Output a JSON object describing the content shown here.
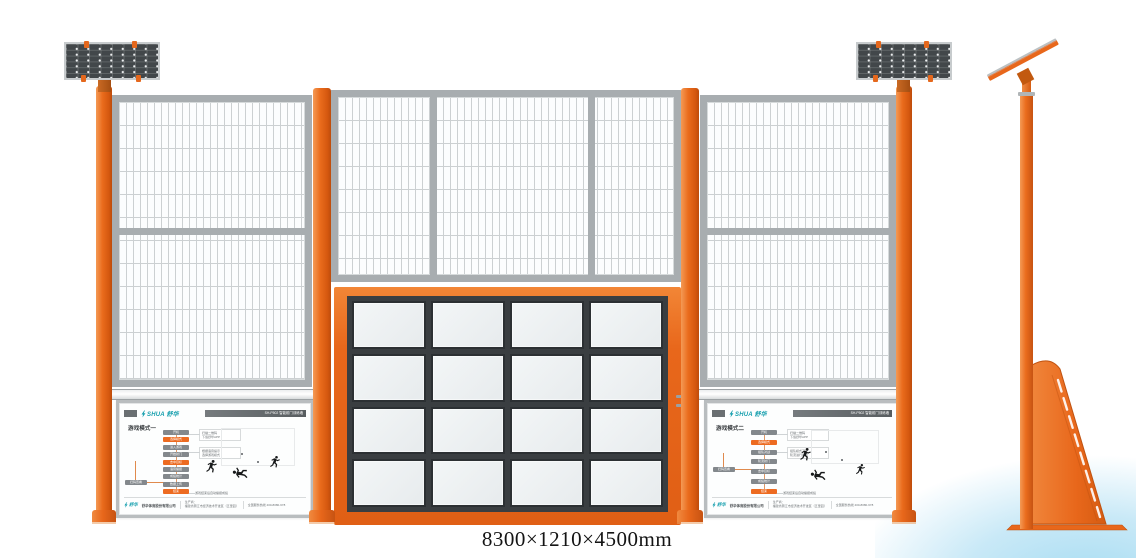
{
  "page": {
    "dimension_label": "8300×1210×4500mm"
  },
  "colors": {
    "orange": "#e8671b",
    "orange_dark": "#c75312",
    "frame_gray": "#a8adb0",
    "mesh_line": "#ccd0d2",
    "solar_cell_dark": "#42474a",
    "screen_frame_dark": "#3a3e41",
    "screen_white": "#eef2f3",
    "brand_teal": "#169fae",
    "pill_gray": "#83888c",
    "pill_orange": "#ed6b21",
    "sky_blue": "#a6dcf2"
  },
  "board_common": {
    "brand": "SHUA 舒华",
    "model": "SH-P502 智能射门训练墙",
    "footer": {
      "logo": "舒华",
      "company": "舒华体育股份有限公司",
      "maker_label": "生产商：",
      "maker_text": "生产商：\n福建省晋江市经济技术开发区（五里园）",
      "hotline": "全国服务热线 400-8080-678"
    }
  },
  "boards": {
    "left": {
      "title": "游戏模式一",
      "steps": [
        {
          "label": "开机",
          "color": "gray"
        },
        {
          "label": "选择模式",
          "color": "orange"
        },
        {
          "label": "进入游戏",
          "color": "gray"
        },
        {
          "label": "开始射门",
          "color": "gray"
        },
        {
          "label": "击中目标",
          "color": "orange"
        },
        {
          "label": "语音播报",
          "color": "gray"
        },
        {
          "label": "成绩统计",
          "color": "gray"
        },
        {
          "label": "数据上传",
          "color": "gray"
        },
        {
          "label": "结束",
          "color": "orange"
        }
      ],
      "side_step": "扫码查看",
      "notes": [
        "扫描二维码\n下载舒华APP",
        "根据语音提示\n选择游戏模式"
      ],
      "bottom_note": "游戏结束后自动播报成绩"
    },
    "right": {
      "title": "游戏模式二",
      "steps": [
        {
          "label": "开机",
          "color": "gray"
        },
        {
          "label": "选择模式",
          "color": "orange"
        },
        {
          "label": "组队对战",
          "color": "gray"
        },
        {
          "label": "轮流射门",
          "color": "gray"
        },
        {
          "label": "击中目标",
          "color": "gray"
        },
        {
          "label": "成绩统计",
          "color": "gray"
        },
        {
          "label": "结束",
          "color": "orange"
        }
      ],
      "side_step": "扫码查看",
      "notes": [
        "扫描二维码\n下载舒华APP",
        "组队模式下\n轮流进行射门"
      ],
      "bottom_note": "游戏结束后自动播报成绩"
    }
  }
}
